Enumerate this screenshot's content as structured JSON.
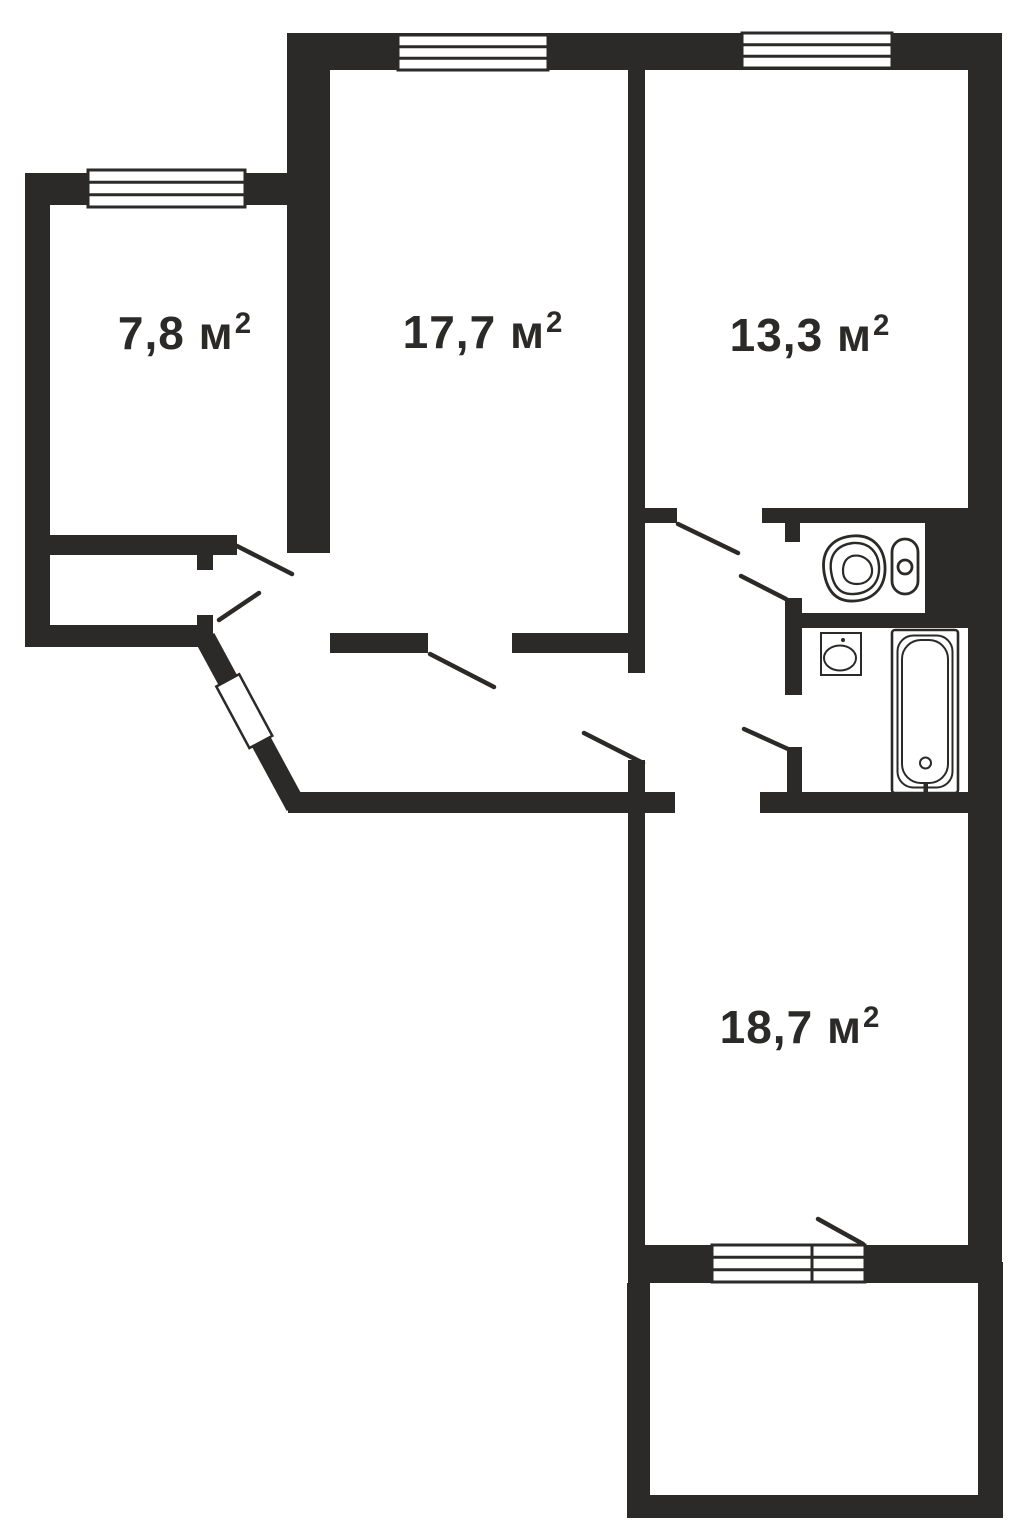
{
  "plan": {
    "type": "apartment-floor-plan",
    "rooms": [
      {
        "id": "room-top-left",
        "area_text": "7,8 м",
        "sup": "2",
        "area_m2": 7.8
      },
      {
        "id": "room-top-middle",
        "area_text": "17,7 м",
        "sup": "2",
        "area_m2": 17.7
      },
      {
        "id": "room-top-right",
        "area_text": "13,3 м",
        "sup": "2",
        "area_m2": 13.3
      },
      {
        "id": "room-bottom",
        "area_text": "18,7 м",
        "sup": "2",
        "area_m2": 18.7
      }
    ],
    "icons": {
      "toilet": "toilet-icon",
      "sink": "sink-icon",
      "bathtub": "bathtub-icon",
      "windows": [
        "window-room-top-left",
        "window-room-top-middle",
        "window-room-top-right",
        "balcony-window-door-unit"
      ],
      "doors": [
        "entrance-door",
        "door-swing-lines"
      ]
    },
    "colors": {
      "wall": "#2b2a28",
      "background": "#ffffff"
    }
  }
}
